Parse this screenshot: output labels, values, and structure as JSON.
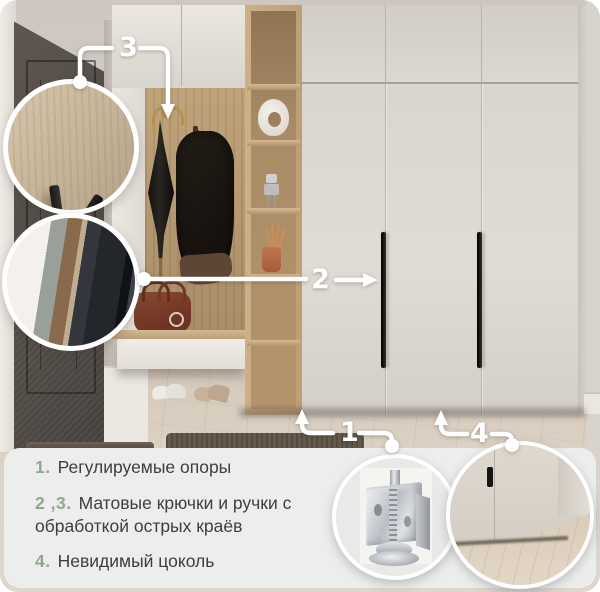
{
  "callouts": {
    "c1": {
      "num": "1",
      "target": "adjustable-feet"
    },
    "c2": {
      "num": "2",
      "target": "door-handle"
    },
    "c3": {
      "num": "3",
      "target": "coat-hook"
    },
    "c4": {
      "num": "4",
      "target": "invisible-plinth"
    }
  },
  "features": [
    {
      "num": "1.",
      "text": "Регулируемые опоры"
    },
    {
      "num": "2 ,3.",
      "text": "Матовые крючки и ручки с обработкой острых краёв"
    },
    {
      "num": "4.",
      "text": "Невидимый цоколь"
    }
  ],
  "details": [
    {
      "name": "hook-detail",
      "shows": "matte black wall hook on oak panel"
    },
    {
      "name": "handle-edge-detail",
      "shows": "matte handle profile close-up"
    },
    {
      "name": "adjustable-foot-detail",
      "shows": "metal adjustable support foot"
    },
    {
      "name": "plinth-detail",
      "shows": "wardrobe bottom with invisible plinth"
    }
  ],
  "colors": {
    "accent_green": "#8caa8e",
    "panel_bg": "#ecedec",
    "text_dark": "#3e3e3e",
    "callout_white": "#ffffff",
    "wardrobe_cream": "#dcd7d0",
    "oak_wood": "#bd9f76",
    "door_dark": "#56504b",
    "floor_wood": "#d8cdbf"
  }
}
